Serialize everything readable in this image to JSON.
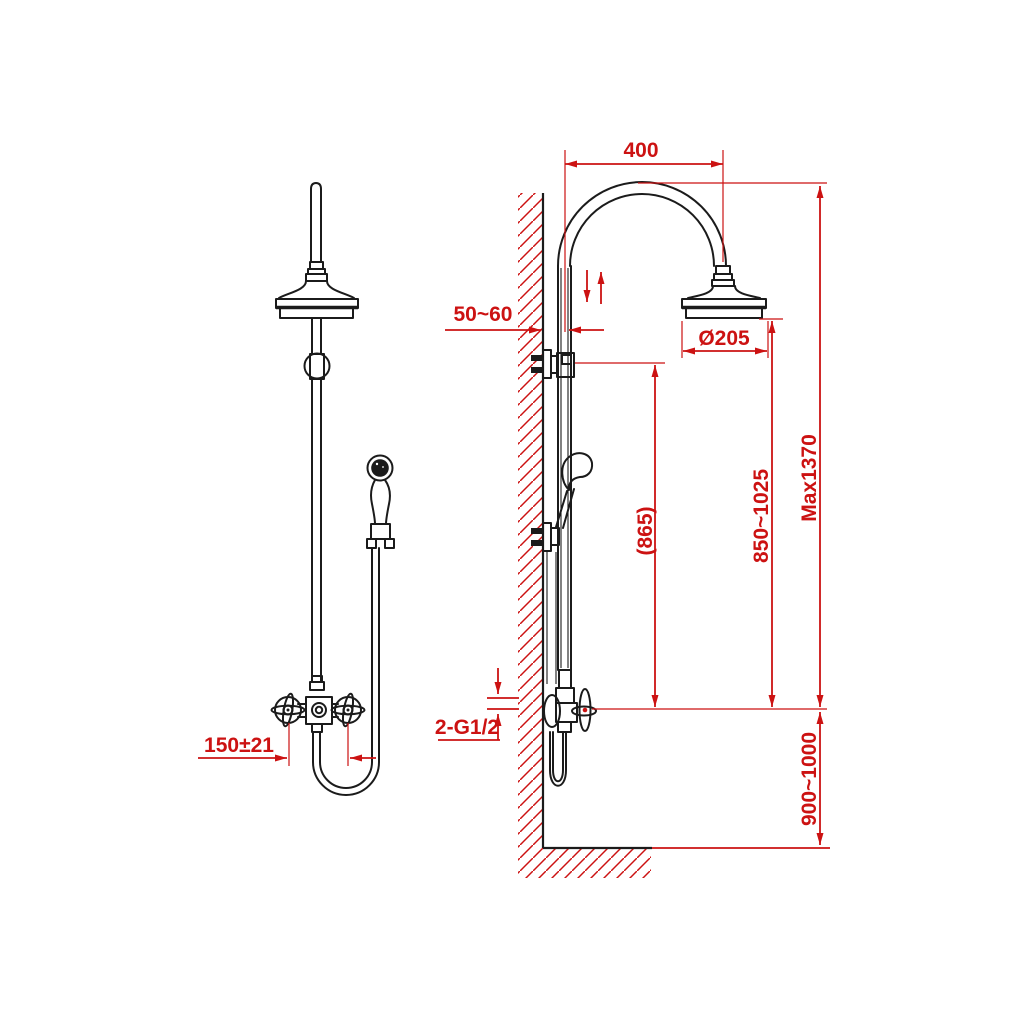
{
  "drawing": {
    "colors": {
      "linework": "#1b1b1b",
      "dimension": "#cc1212",
      "background": "#ffffff"
    },
    "dimensions": {
      "arm_reach": "400",
      "wall_offset": "50~60",
      "head_diameter": "Ø205",
      "bracket_to_valve": "(865)",
      "head_to_valve": "850~1025",
      "max_height": "Max1370",
      "inlet_thread": "2-G1/2",
      "valve_to_floor": "900~1000",
      "inlet_spacing": "150±21"
    }
  }
}
